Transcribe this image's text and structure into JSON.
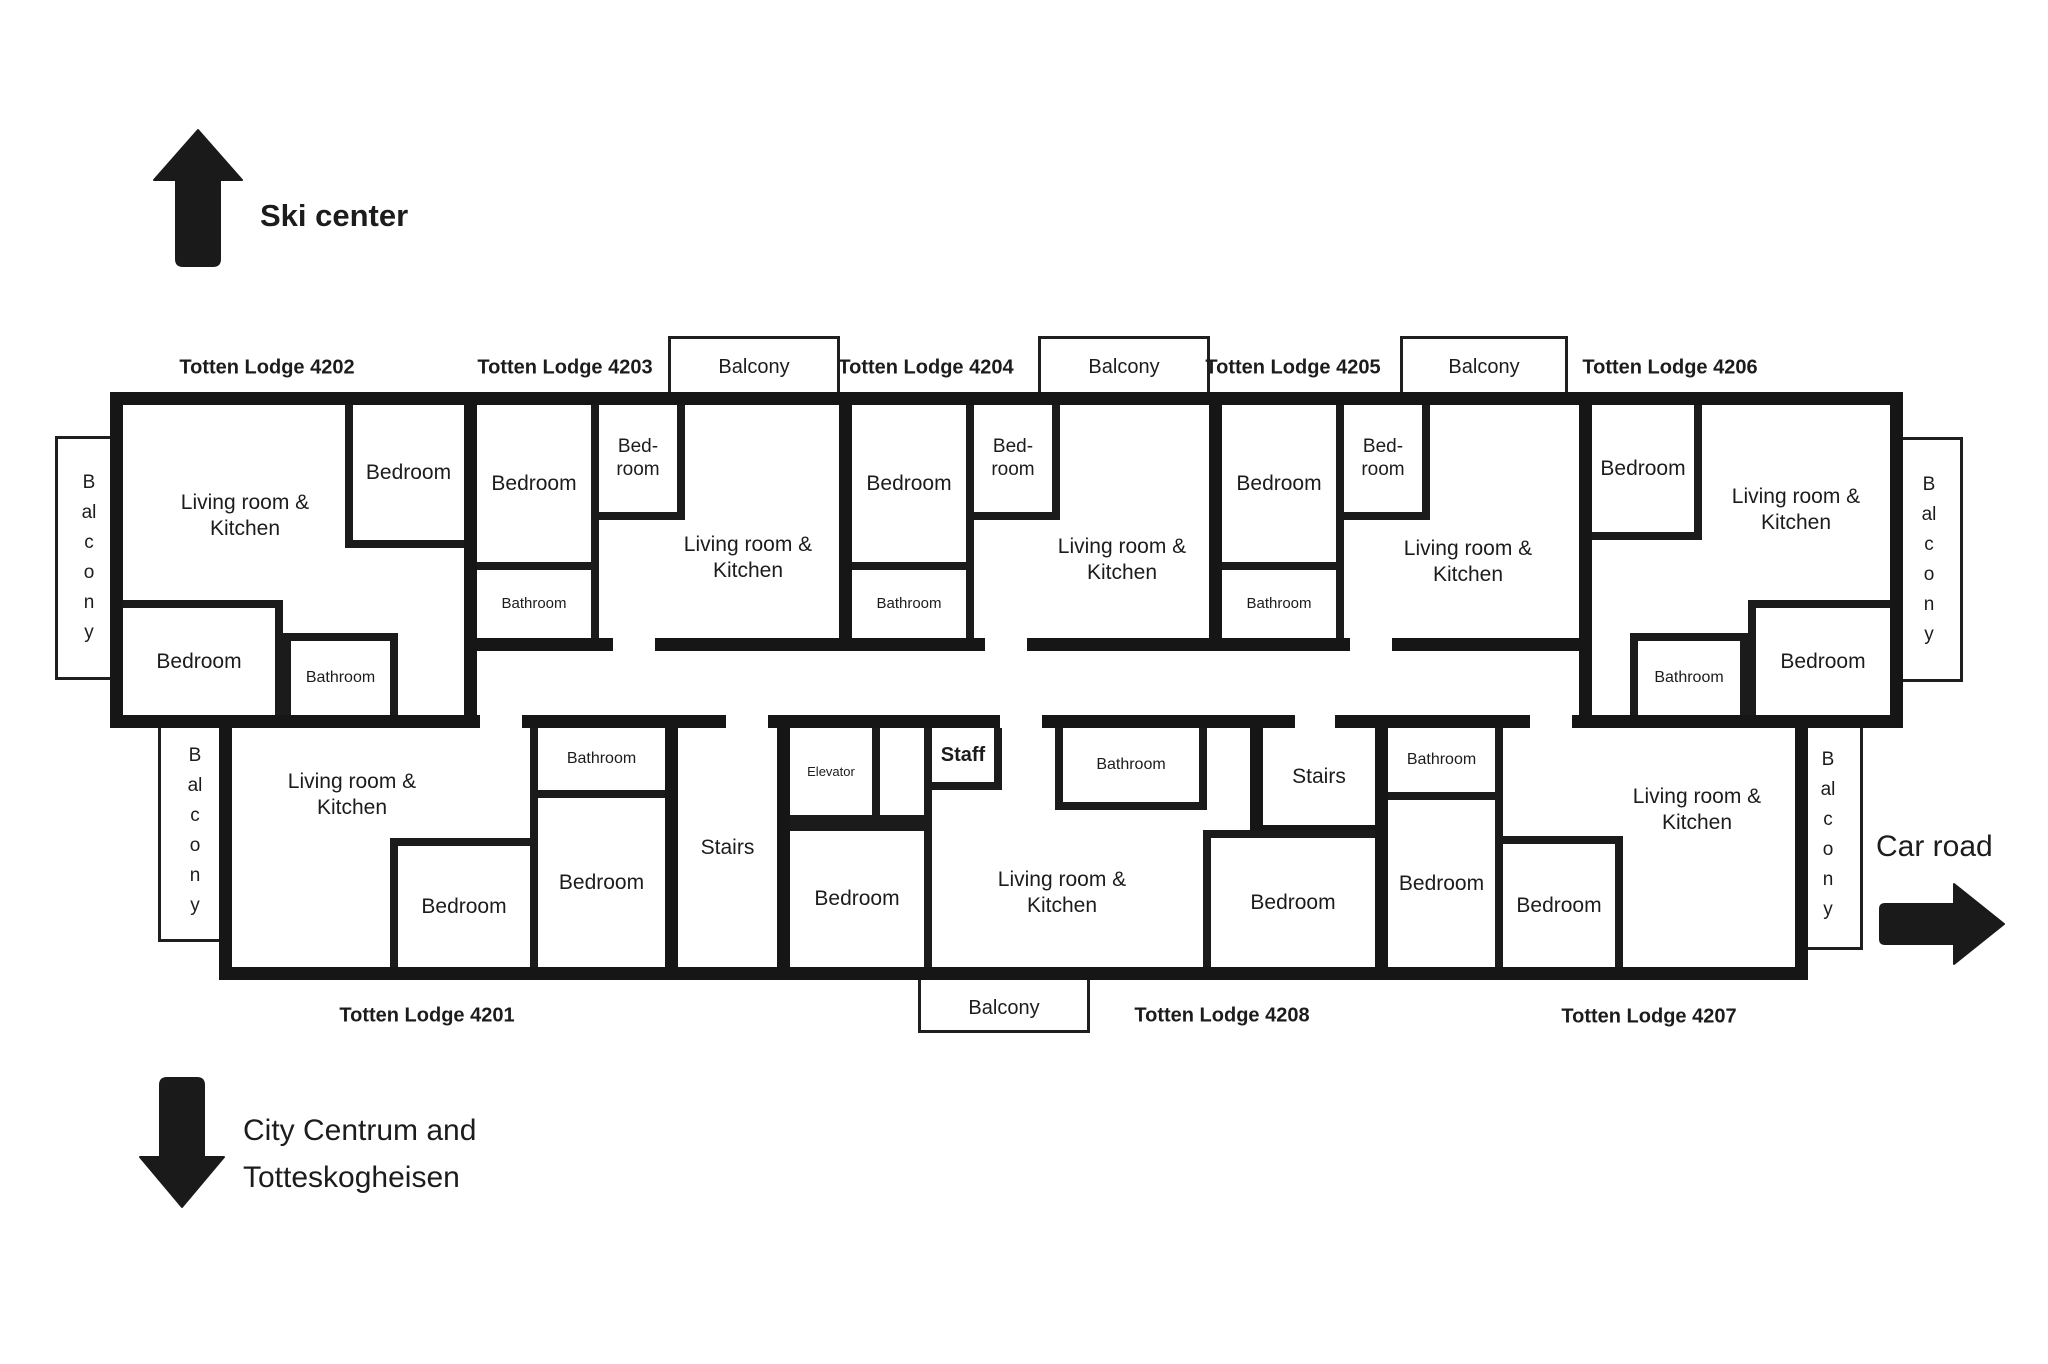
{
  "directions": {
    "ski_center": "Ski center",
    "city_line1": "City Centrum and",
    "city_line2": "Totteskogheisen",
    "car_road": "Car road"
  },
  "room_labels": {
    "living_kitchen": "Living room & Kitchen",
    "bedroom": "Bedroom",
    "bedroom_split": "Bed-room",
    "bathroom": "Bathroom",
    "balcony": "Balcony",
    "stairs": "Stairs",
    "elevator": "Elevator",
    "staff": "Staff"
  },
  "lodges": {
    "l4202": "Totten Lodge 4202",
    "l4203": "Totten Lodge 4203",
    "l4204": "Totten Lodge 4204",
    "l4205": "Totten Lodge 4205",
    "l4206": "Totten Lodge 4206",
    "l4201": "Totten Lodge 4201",
    "l4208": "Totten Lodge 4208",
    "l4207": "Totten Lodge 4207"
  }
}
